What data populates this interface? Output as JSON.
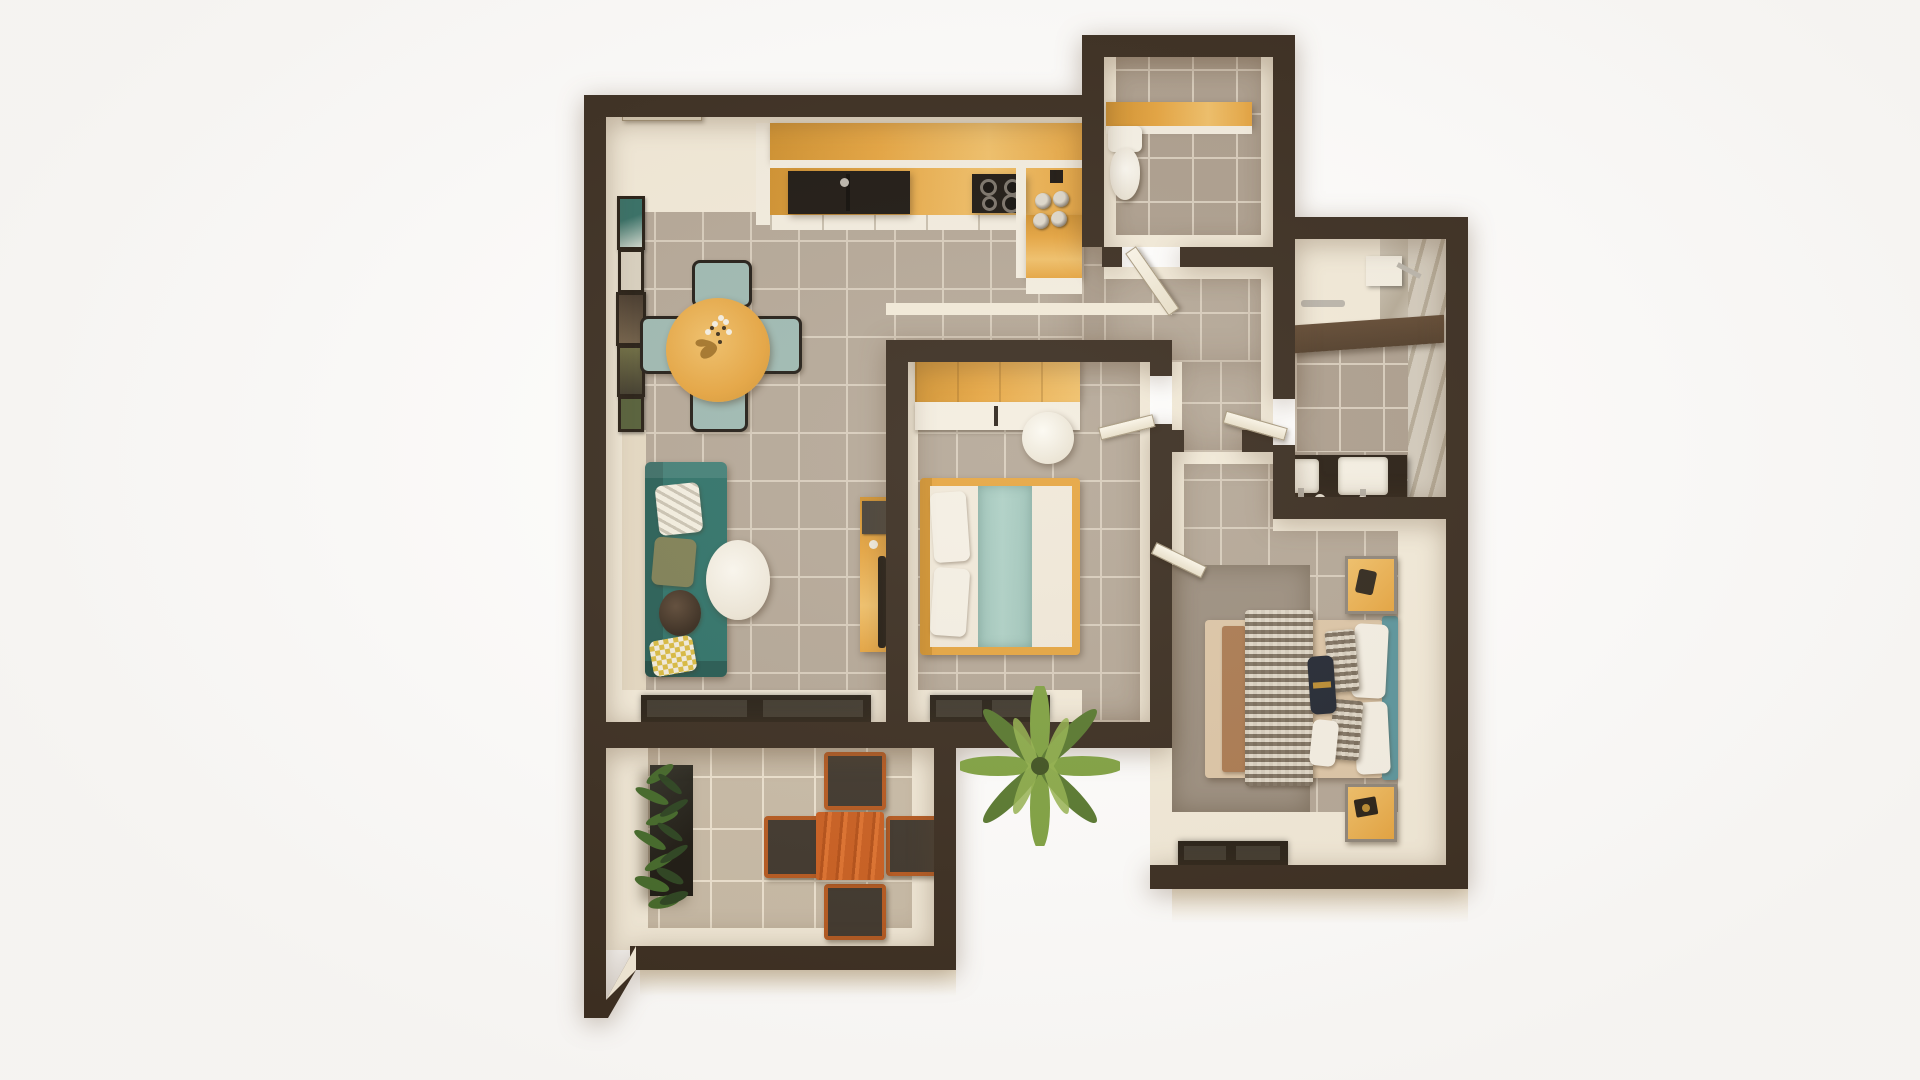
{
  "scene": {
    "title": "Top-down 3D render of a one-plus-bedroom apartment floor plan",
    "background": "#ffffff",
    "image_size": "1920x1080",
    "text_visible": "none"
  },
  "palette": {
    "white": "#ffffff",
    "wall": "#36291d",
    "face": "#f2ead9",
    "faceDim": "#e4d8c2",
    "entry": "#efe7d4",
    "tile": "#b3a696",
    "grout": "#d7ccbc",
    "tileBalc": "#c7baa6",
    "groutBalc": "#ece2d0",
    "tileBath": "#ab9d8d",
    "wood": "#e5a33d",
    "woodLight": "#f0bf67",
    "woodDeep": "#cf8f2b",
    "counterWhite": "#f3ede0",
    "appliance": "#17120d",
    "steel": "#b9b4ab",
    "sofa": "#2a6f66",
    "chairTeal": "#9cb8b1",
    "headboard": "#58939b",
    "seafoam": "#accfc5",
    "mattress": "#f0e8d9",
    "mattressTan": "#dcc5a6",
    "pillowWhite": "#f4efe4",
    "plaidA": "#8b7c69",
    "plaidB": "#ded5c6",
    "brownBlanket": "#a9784f",
    "rug": "#9a8d7e",
    "navy": "#1e2430",
    "gold": "#b98a2f",
    "terracotta": "#c95c1d",
    "chairDark": "#3b332a",
    "chairFrame": "#b4561c",
    "plantDark": "#27401d",
    "plantMid": "#3f6626",
    "palmGreen": "#7da03f",
    "palmDark": "#55762c",
    "marble": "#d2cabc",
    "marbleVein": "#b4a996",
    "ledge": "#4e3a27",
    "vanity": "#241a10",
    "matDark": "#231c13",
    "matPane": "#3b352b",
    "frameDark": "#1f170e",
    "artTeal": "#2f6b62",
    "artPale": "#d8d0bf",
    "artSepia": "#3e3125",
    "artOlive": "#67663c",
    "artMoss": "#4f5a33",
    "cream": "#efe5d0"
  },
  "rooms": [
    {
      "id": "living-kitchen-dining",
      "label": "Open living, dining and kitchen room",
      "furniture": [
        "entry door",
        "kitchen wall cabinets",
        "kitchen counter with black double sink",
        "black 4-burner cooktop",
        "storage canisters on corner counter",
        "counter peninsula",
        "gallery of five wall art frames",
        "round wooden dining table with flowers",
        "four teal dining chairs",
        "teal three-seat sofa with four pillows",
        "white oval coffee table",
        "wooden desk with laptop and black chair",
        "sliding glass balcony door"
      ]
    },
    {
      "id": "bedroom-1",
      "label": "Bedroom 1 (center)",
      "furniture": [
        "sliding-door wardrobe",
        "white round pouf",
        "double bed with wooden frame, white bedding, seafoam runner and two white pillows",
        "hinged entry door",
        "sliding glass balcony door"
      ]
    },
    {
      "id": "wc",
      "label": "Toilet room (top)",
      "furniture": [
        "wall-hung toilet",
        "wooden shelf counter",
        "hinged door"
      ]
    },
    {
      "id": "hallway",
      "label": "L-shaped hallway",
      "furniture": [
        "doors to WC, shower room, bedroom 1 and bedroom 2"
      ]
    },
    {
      "id": "shower-room",
      "label": "Shower room (right)",
      "furniture": [
        "walk-in shower with chrome fixture",
        "marble wall",
        "dark stone ledge",
        "towel bar",
        "dark double vanity with two white basins"
      ]
    },
    {
      "id": "bedroom-2",
      "label": "Bedroom 2 (bottom right)",
      "furniture": [
        "grey area rug",
        "double bed with tan bedding, brown throw and houndstooth plaid blanket",
        "teal headboard with pillow set and black accent pillow",
        "two wood-and-steel nightstands with accessories",
        "hinged door",
        "sliding glass door"
      ]
    },
    {
      "id": "balcony",
      "label": "Balcony / terrace (bottom)",
      "furniture": [
        "tall dark planter with green plant",
        "orange outdoor dining table",
        "four dark outdoor chairs",
        "potted palm at the corner",
        "chamfered corner wall"
      ]
    }
  ]
}
